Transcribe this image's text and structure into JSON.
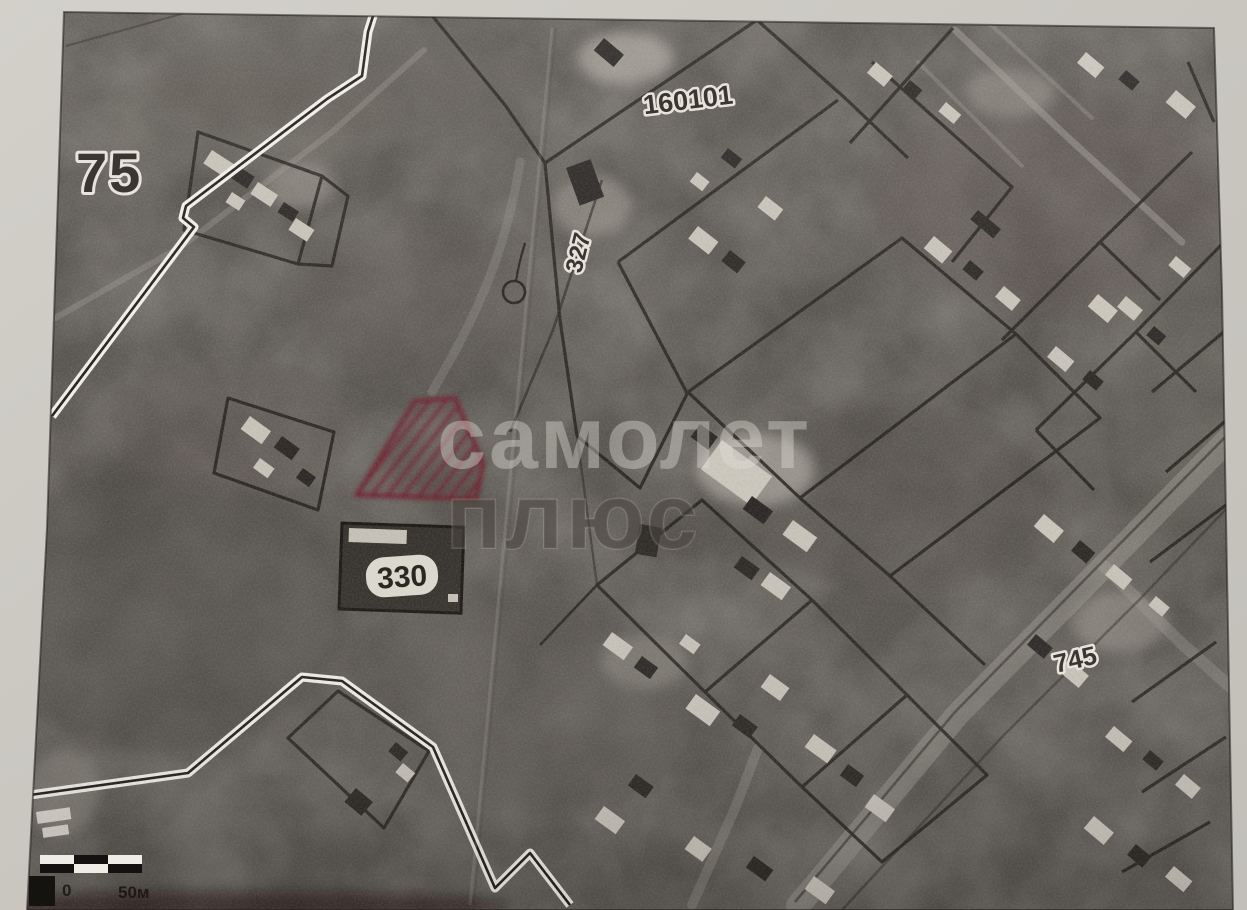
{
  "document": {
    "kind": "scanned satellite cadastral plan photo",
    "quarter_label": "75",
    "block_label": "160101",
    "parcel_327": "327",
    "parcel_330": "330",
    "parcel_745": "745",
    "watermark_line1": "самолет",
    "watermark_line2": "плюс",
    "scale_start": "0",
    "scale_end": "50м",
    "highlight_color": "#6f2430",
    "paper_color": "#cac7c1",
    "map_base_color": "#57534e"
  }
}
